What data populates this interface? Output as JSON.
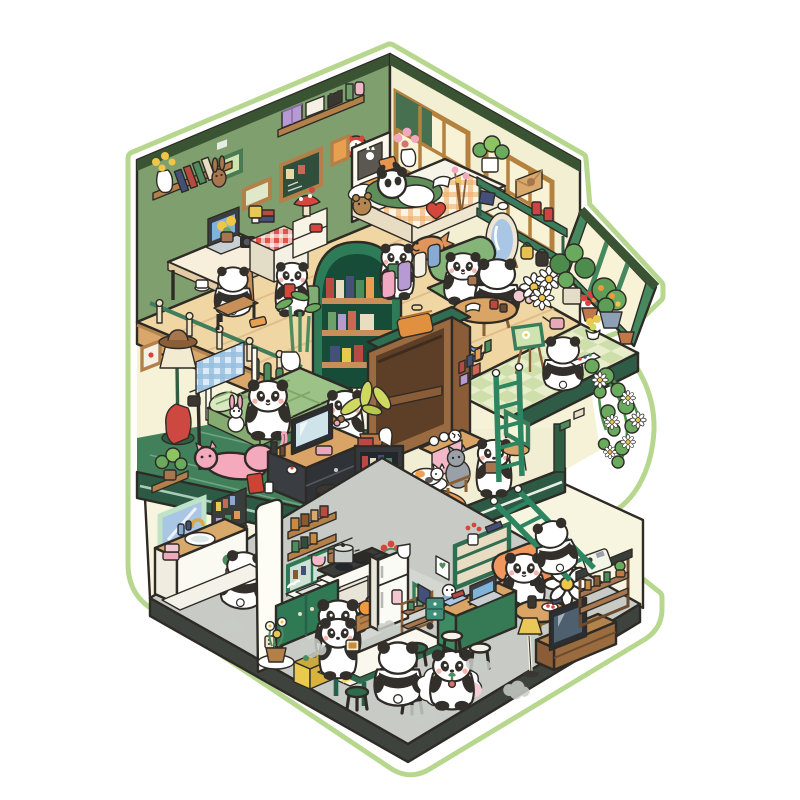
{
  "palette": {
    "ink": "#2e2b26",
    "sticker": "#b7d78e",
    "wallGreen": "#7fa06e",
    "wallGreenDark": "#3a5433",
    "wallCream": "#f2efd2",
    "windowTan": "#b5813f",
    "paneCream": "#f8f3d6",
    "paneGreen": "#46704f",
    "wood": "#f0d6a2",
    "plank": "#e0be8a",
    "woodSide": "#daa76b",
    "woodLip": "#b5854f",
    "shelfWood": "#b3804a",
    "gardenA": "#e8edcb",
    "gardenB": "#cedfac",
    "gardenSlab": "#2e5c47",
    "archGreen": "#2e7c57",
    "archDark": "#174c39",
    "floorGreen": "#41805a",
    "floorLine": "#6fa583",
    "slabGreen": "#2c5a45",
    "slabStripe": "#a8cdb4",
    "creamFloor": "#f2eed3",
    "rugOrange": "#ec9d5b",
    "sofaGreen": "#85b478",
    "quiltGreen": "#9cc287",
    "pinkCat": "#f5a9bc",
    "tvDark": "#2b2f33",
    "screenBlue": "#4e5f70",
    "screenPale": "#cfe3ea",
    "wardrobe": "#9a6a41",
    "wardrobeIn": "#5d3f28",
    "wardrobeTop": "#2f6e50",
    "ladder": "#2e8562",
    "vine": "#4e8c4e",
    "leaf": "#69aa5e",
    "daisyCenter": "#f0c64a",
    "groundWall": "#f7f5df",
    "grayFloor": "#c8cbc5",
    "grayTile": "#d4d7d1",
    "baseDark": "#3e433d",
    "cabGreen": "#2f7a55",
    "fridge": "#fbfbf5",
    "crate": "#e9c94e",
    "stoolGreen": "#2e6b4c",
    "tableWhite": "#faf8ee",
    "runner": "#f2d464",
    "armOrange": "#ec8c50",
    "deskGreen": "#3e8a62",
    "lampYellow": "#e9c858",
    "rugPink": "#f6cdd6",
    "puff": "#c9cdc7",
    "pandaWhite": "#ffffff",
    "pandaBlack": "#33302b",
    "blush": "#f5b4ab",
    "red": "#d5463c",
    "mint": "#bfe3c8",
    "blueGlass": "#a9c6e4",
    "steel": "#c8ccc9",
    "teal": "#3f8f7a",
    "pinkBox": "#eeaabc"
  },
  "scene": {
    "type": "isometric-cutaway-sticker-illustration",
    "subject": "panda-family-dollhouse",
    "floors": [
      {
        "name": "attic-study-and-bedroom",
        "items": [
          "wall-shelf-with-boxes",
          "flower-vase-shelf",
          "picture-frames",
          "chalkboard",
          "alarm-clock",
          "desk-with-laptop",
          "panda-at-desk",
          "gingham-table",
          "mushroom-lamp-dresser",
          "standing-panda",
          "arch-bookcase",
          "bamboo-plant",
          "slab-railing",
          "bed-with-lying-panda",
          "teddy-bear",
          "heart-pillow",
          "shoji-windows",
          "green-wall-shelf",
          "standing-mirror",
          "hand-bags",
          "taiyaki-plush",
          "panda-with-book",
          "green-armchair-panda",
          "back-view-panda",
          "low-round-table",
          "daisy-bouquet"
        ]
      },
      {
        "name": "garden-balcony",
        "items": [
          "glass-awning",
          "checker-floor",
          "monstera",
          "flower-pots",
          "orange-tree",
          "watering-can",
          "painting-panda",
          "easel",
          "paint-box",
          "blue-bowls",
          "hanging-flower-vine"
        ]
      },
      {
        "name": "middle-bedroom-and-dressing",
        "items": [
          "floor-lamp-with-hat",
          "coat-stand",
          "gingham-canopy-bed",
          "panda-on-bed",
          "bunny-plush",
          "donut-panda",
          "pink-cat",
          "tv-dresser",
          "black-pot-stool",
          "snack-bag",
          "wardrobe-with-suitcase",
          "palm-plant",
          "dark-bookshelf",
          "table-with-gray-cat",
          "cat-tower-with-cat",
          "orange-rug",
          "panda-with-book",
          "vertical-ladder",
          "wall-window",
          "corner-stool"
        ]
      },
      {
        "name": "ground-floor",
        "items": [
          "shelf-plant",
          "bathroom-mirror",
          "toiletry-shelf",
          "towels",
          "sink-counter",
          "washing-panda",
          "partition-wall",
          "kitchen-shelves",
          "glass-cabinet",
          "hanging-utensils",
          "stove-with-pots",
          "kitchen-sink",
          "green-cabinets",
          "cooking-panda",
          "vegetable-basket",
          "refrigerator",
          "utility-cart",
          "yellow-crate",
          "white-flower-pot",
          "dining-mat",
          "dining-table",
          "green-stools",
          "dining-panda",
          "toast-panda",
          "cloud-rug-panda",
          "study-green-bookshelf",
          "wall-frames",
          "orange-armchair-panda",
          "round-side-table",
          "giant-daisy",
          "television",
          "tv-cabinet",
          "shelf-unit-with-machine",
          "snowman-toy",
          "green-desk-laptop",
          "teal-drawers",
          "white-stools",
          "yellow-floor-lamp",
          "slanted-ladder-panda",
          "steam-puffs"
        ]
      }
    ]
  }
}
